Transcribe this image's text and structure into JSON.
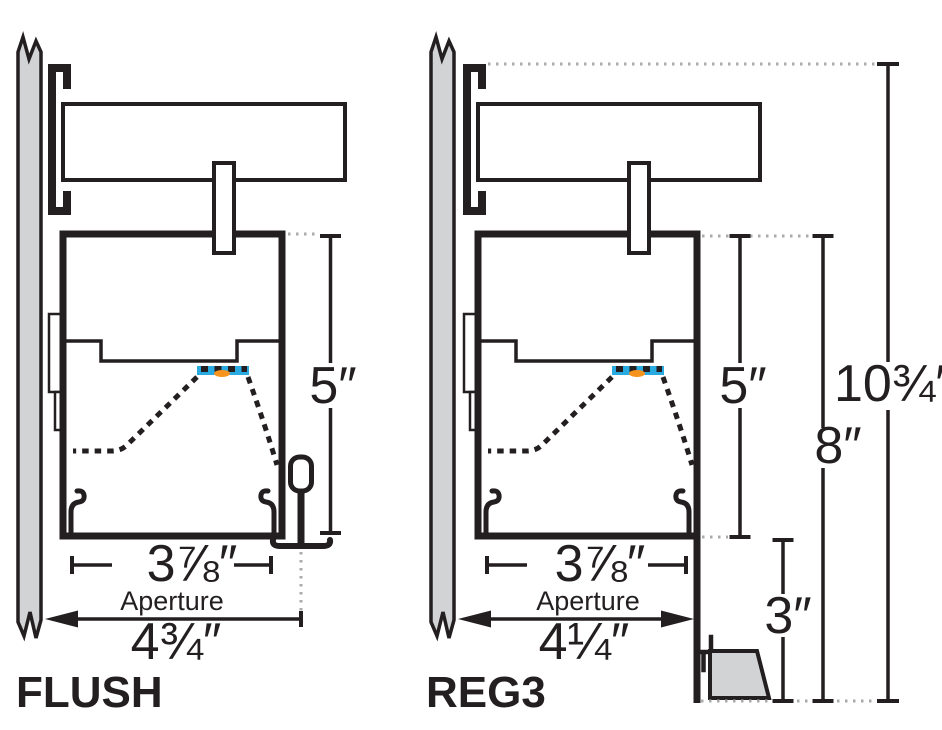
{
  "diagram": {
    "kind": "linear-lighting-fixture-mounting-cross-sections",
    "colors": {
      "line": "#231F20",
      "wall_fill": "#D2D3D5",
      "led_strip": "#29ABE2",
      "led_source": "#F7941D",
      "leader_dots": "#A9ABAE"
    }
  },
  "figures": [
    {
      "name": "FLUSH",
      "height": "5″",
      "aperture": "3⅞″",
      "aperture_label": "Aperture",
      "depth": "4¾″"
    },
    {
      "name": "REG3",
      "height": "5″",
      "aperture": "3⅞″",
      "aperture_label": "Aperture",
      "depth": "4¼″",
      "flange_height": "8″",
      "overall_height": "10¾″",
      "regress_height": "3″"
    }
  ]
}
